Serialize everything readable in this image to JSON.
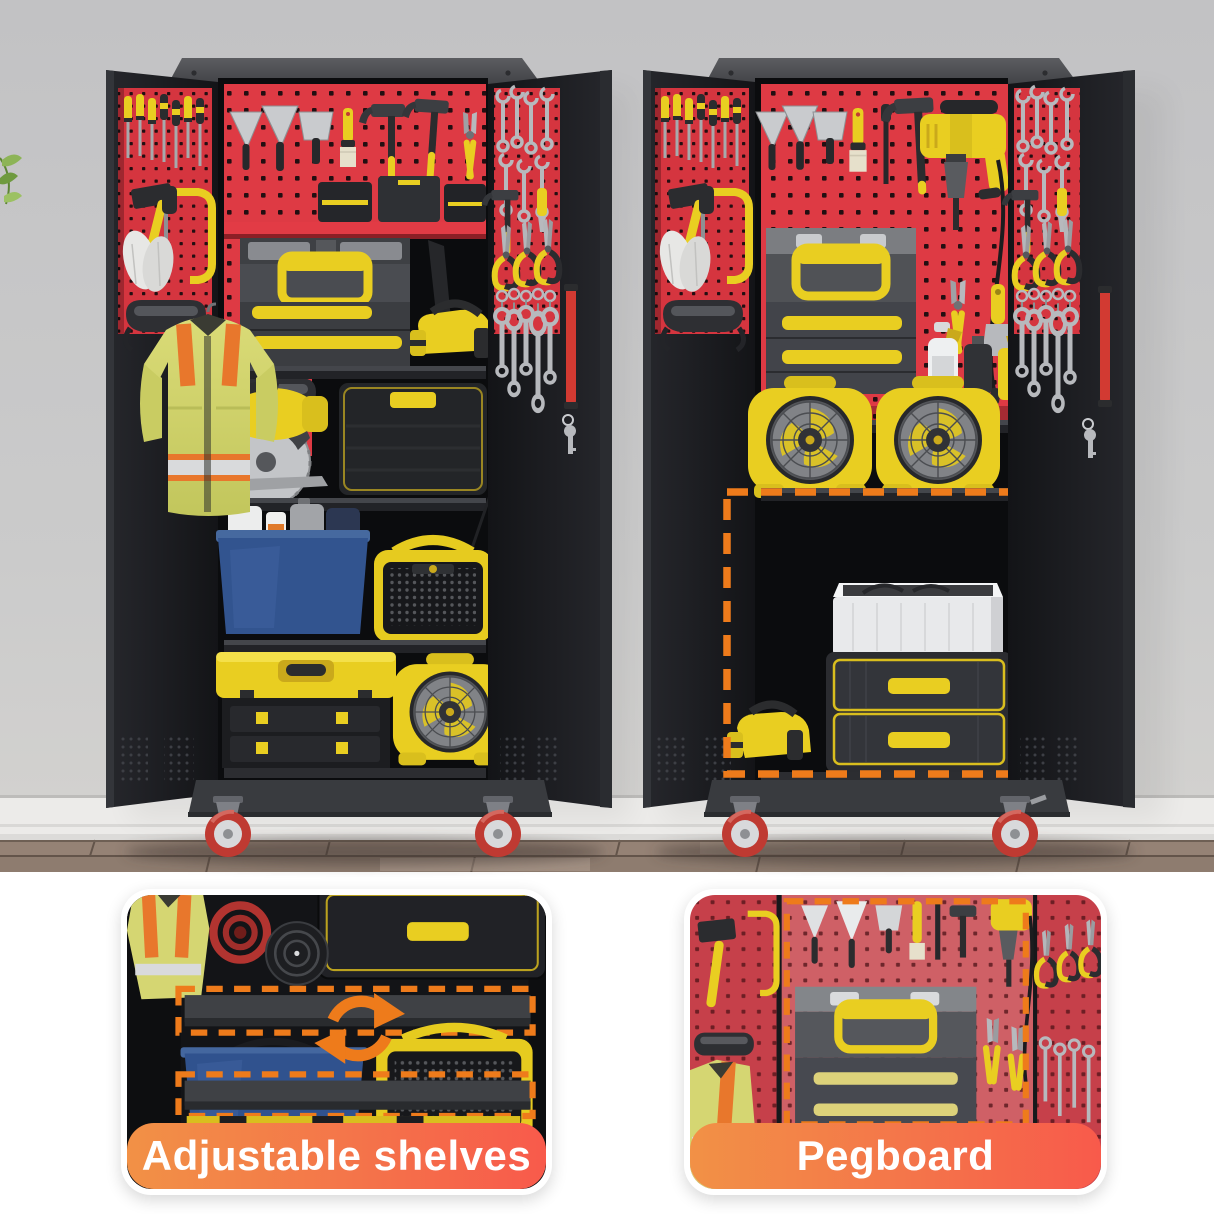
{
  "image": {
    "type": "product marketing photo",
    "subject": "rolling metal garage tool storage cabinets with pegboard doors, shown open and filled with tools"
  },
  "callouts": [
    {
      "label": "Adjustable shelves"
    },
    {
      "label": "Pegboard"
    }
  ],
  "colors": {
    "pegboard_red": "#de3a44",
    "door_pegboard_red": "#d5353f",
    "cabinet_black": "#17181b",
    "tool_yellow": "#e9ce21",
    "highlight_orange": "#ee7b1b",
    "label_gradient_start": "#f29146",
    "label_gradient_end": "#f85a4b",
    "caster_red": "#bf3a32",
    "wall_gray": "#c9c9cb",
    "floor_wood": "#8e7c6f",
    "vest_yellow_green": "#d5d672"
  },
  "scene": {
    "left_cabinet_items": [
      "screwdrivers",
      "sledgehammer",
      "hacksaw",
      "work-gloves",
      "safety-goggles",
      "safety-vest",
      "trowels",
      "putty-knife",
      "paint-brush",
      "claw-hammers",
      "pliers",
      "parts-organizers",
      "portable-toolbox",
      "staple-gun",
      "pry-bar",
      "circular-saw",
      "drawer-case",
      "storage-bin-with-bottles",
      "jobsite-radio",
      "cantilever-toolbox",
      "portable-fan",
      "combination-wrenches",
      "tin-snips",
      "ratchet-wrenches",
      "door-handle",
      "key"
    ],
    "right_cabinet_items": [
      "screwdrivers",
      "sledgehammer",
      "hacksaw",
      "work-gloves",
      "safety-goggles",
      "trowels",
      "putty-knife",
      "paint-brush",
      "awl",
      "claw-hammer",
      "power-drill",
      "portable-toolbox",
      "wire-stripper",
      "scraper",
      "spray-bottle",
      "oil-can",
      "portable-fans",
      "white-storage-bin",
      "two-drawer-chest",
      "staple-gun",
      "combination-wrenches",
      "tin-snips",
      "ratchet-wrenches",
      "door-handle",
      "key",
      "highlighted-adjustable-area"
    ]
  }
}
